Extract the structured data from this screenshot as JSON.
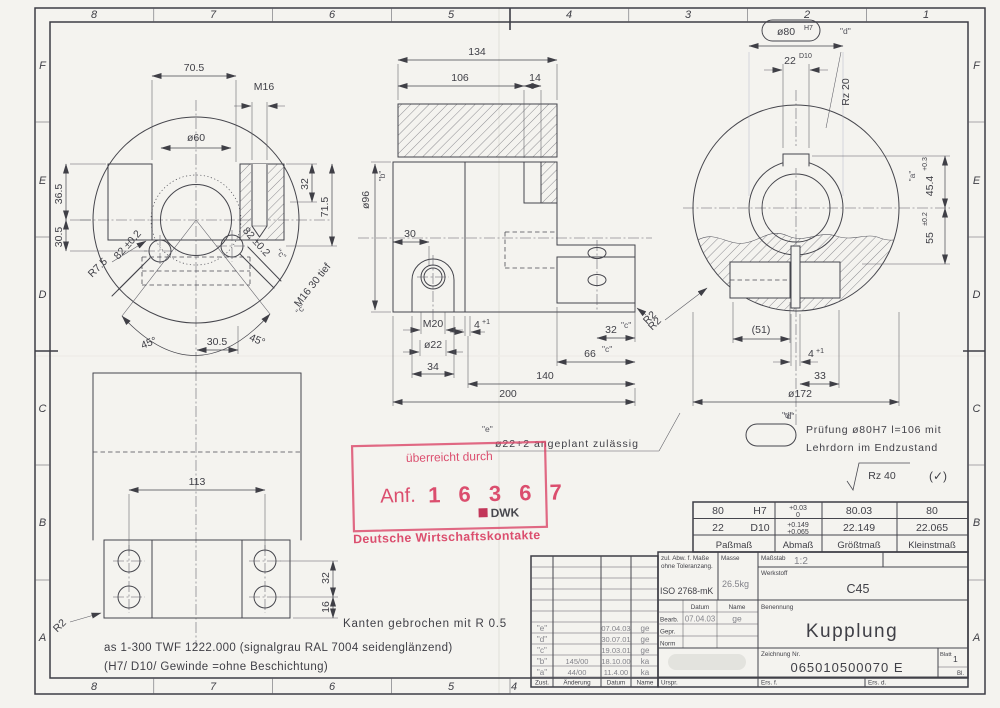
{
  "colors": {
    "paper": "#f4f3ef",
    "ink": "#3f3f46",
    "stamp_red": "#da4668",
    "pencil": "#83838a"
  },
  "frame": {
    "cols": [
      "8",
      "7",
      "6",
      "5",
      "4",
      "3",
      "2",
      "1"
    ],
    "rows": [
      "F",
      "E",
      "D",
      "C",
      "B",
      "A"
    ]
  },
  "front_view": {
    "dims": {
      "w705": "70.5",
      "m16": "M16",
      "d60": "ø60",
      "h365": "36.5",
      "h305": "30.5",
      "w32": "32",
      "h715": "71.5",
      "diag_l": "82 ±0.2",
      "diag_r": "82 ±0.2",
      "ref_c1": "\"c\"",
      "ref_c2": "\"c\"",
      "r75": "R7.5",
      "m16_tief": "M16 30 tief",
      "a45_l": "45°",
      "a45_r": "45°",
      "w305": "30.5"
    }
  },
  "section_view": {
    "dims": {
      "l134": "134",
      "l106": "106",
      "l14": "14",
      "d96": "ø96",
      "ref_b": "\"b\"",
      "w30": "30",
      "m20": "M20",
      "g4": "4",
      "g4_tol": "+1",
      "d22": "ø22",
      "w34": "34",
      "w32": "32",
      "ref_c1": "\"c\"",
      "w66": "66",
      "ref_c2": "\"c\"",
      "l140": "140",
      "l200": "200",
      "r2": "R2",
      "ref_e": "\"e\"",
      "note": "ø22+2 angeplant zulässig"
    }
  },
  "end_view": {
    "dims": {
      "callout": "ø80",
      "callout_fit": "H7",
      "ref_d1": "\"d\"",
      "k22": "22",
      "k22_fit": "D10",
      "rz20": "Rz 20",
      "ref_a": "\"a\"",
      "d454": "45.4",
      "d454_tol": "+0.3",
      "d55": "55",
      "d55_tol": "±0.2",
      "l51": "(51)",
      "g4": "4",
      "g4_tol": "+1",
      "w33": "33",
      "d172": "ø172",
      "ref_d2": "\"d\"",
      "r2": "R2",
      "ref_d3": "\"d\"",
      "rz40": "Rz 40",
      "check": "(✓)"
    },
    "note1": "Prüfung ø80H7 l=106 mit",
    "note2": "Lehrdorn im Endzustand"
  },
  "bottom_view": {
    "dims": {
      "w113": "113",
      "h32": "32",
      "h16": "16",
      "r2": "R2"
    }
  },
  "notes": {
    "n1": "Kanten gebrochen mit R 0.5",
    "n2": "as 1-300 TWF 1222.000 (signalgrau RAL 7004 seidenglänzend)",
    "n3": "(H7/ D10/ Gewinde =ohne Beschichtung)"
  },
  "stamp": {
    "l1": "überreicht durch",
    "prefix": "Anf.",
    "number": "1 6 3 6 7",
    "logo": "DWK",
    "l2": "Deutsche Wirtschaftskontakte"
  },
  "fit_table": {
    "headers": [
      "Paßmaß",
      "Abmaß",
      "Größtmaß",
      "Kleinstmaß"
    ],
    "rows": [
      {
        "nom": "80",
        "fit": "H7",
        "dev_hi": "+0.03",
        "dev_lo": "0",
        "max": "80.03",
        "min": "80"
      },
      {
        "nom": "22",
        "fit": "D10",
        "dev_hi": "+0.149",
        "dev_lo": "+0.065",
        "max": "22.149",
        "min": "22.065"
      }
    ]
  },
  "title_block": {
    "tol1": "zul. Abw. f. Maße",
    "tol2": "ohne Toleranzang.",
    "tol_std": "ISO 2768-mK",
    "mass_label": "Masse",
    "mass": "26.5kg",
    "scale_label": "Maßstab",
    "scale": "1:2",
    "material_label": "Werkstoff",
    "material": "C45",
    "datum": "Datum",
    "name": "Name",
    "bearb": "Bearb.",
    "bearb_date": "07.04.03",
    "bearb_name": "ge",
    "gepr": "Gepr.",
    "norm": "Norm",
    "benennung": "Benennung",
    "title": "Kupplung",
    "zng": "Zeichnung Nr.",
    "number": "065010500070 E",
    "blatt": "Blatt",
    "blatt_no": "1",
    "bl": "Bl.",
    "urspr": "Urspr.",
    "ers_f": "Ers. f.",
    "ers_d": "Ers. d."
  },
  "revision_table": {
    "header": [
      "Zust.",
      "Änderung",
      "Datum",
      "Name"
    ],
    "rows": [
      [
        "\"e\"",
        "",
        "07.04.03",
        "ge"
      ],
      [
        "\"d\"",
        "",
        "30.07.01",
        "ge"
      ],
      [
        "\"c\"",
        "",
        "19.03.01",
        "ge"
      ],
      [
        "\"b\"",
        "145/00",
        "18.10.00",
        "ka"
      ],
      [
        "\"a\"",
        "44/00",
        "11.4.00",
        "ka"
      ]
    ]
  }
}
